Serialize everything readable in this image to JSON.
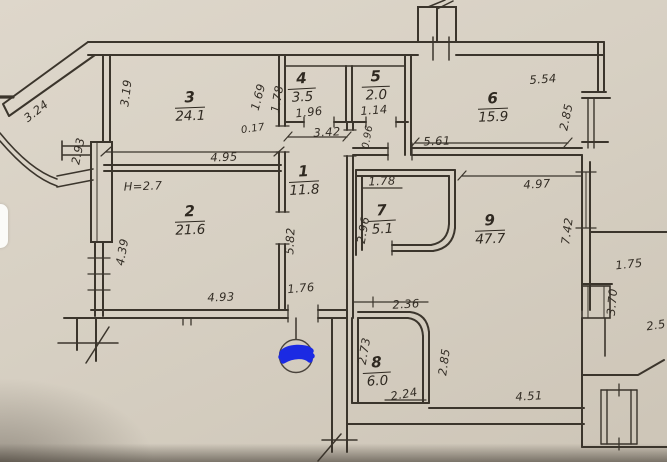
{
  "title": "Hand-drawn apartment floor plan (scan)",
  "colors": {
    "paper": "#d7d0c3",
    "ink": "#3b352c",
    "blue_marker": "#1b2ae3"
  },
  "rooms": [
    {
      "number": "1",
      "area": "11.8"
    },
    {
      "number": "2",
      "area": "21.6"
    },
    {
      "number": "3",
      "area": "24.1"
    },
    {
      "number": "4",
      "area": "3.5"
    },
    {
      "number": "5",
      "area": "2.0"
    },
    {
      "number": "6",
      "area": "15.9"
    },
    {
      "number": "7",
      "area": "5.1"
    },
    {
      "number": "8",
      "area": "6.0"
    },
    {
      "number": "9",
      "area": "47.7"
    }
  ],
  "dims": {
    "diag_balcony": "3.24",
    "room3_left": "3.19",
    "wall_left": "2.93",
    "room3_width": "4.95",
    "room4_left_out": "1.69",
    "room4_left_in": "1.78",
    "room4_width": "1.96",
    "wall_offset": "0.17",
    "hall_top": "3.42",
    "room5_width": "1.14",
    "hall_right": "5.61",
    "room6_width": "5.54",
    "room6_right": "2.85",
    "height_note": "H=2.7",
    "room2_left": "4.39",
    "hall_left": "5.82",
    "room2_bottom": "4.93",
    "hall_door": "1.76",
    "room7_top": "1.78",
    "room7_left": "2.96",
    "door_small": "0.96",
    "room9_top": "4.97",
    "room9_right": "7.42",
    "room8_top": "2.36",
    "room8_left": "2.73",
    "room8_right": "2.85",
    "room8_bottom": "2.24",
    "room9_bottom": "4.51",
    "annex_width": "1.75",
    "annex_height": "3.70",
    "edge_partial": "2.5"
  }
}
